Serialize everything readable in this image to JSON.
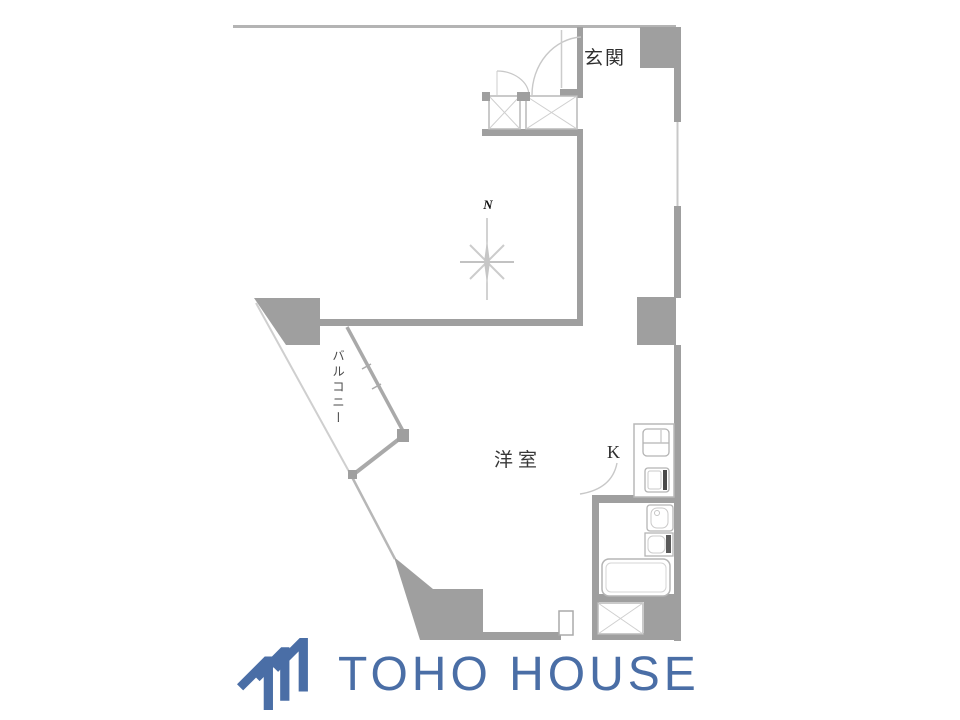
{
  "floor_plan": {
    "labels": {
      "entrance": "玄関",
      "balcony": "バルコニー",
      "western_room": "洋室",
      "kitchen": "K",
      "compass_north": "N"
    }
  },
  "branding": {
    "company_name": "TOHO HOUSE"
  },
  "colors": {
    "wall_gray": "#9f9f9f",
    "thin_line_gray": "#bdbdbd",
    "fixture_line_gray": "#b5b5b5",
    "logo_blue": "#4a6ea6",
    "label_text": "#2f2f2f"
  }
}
